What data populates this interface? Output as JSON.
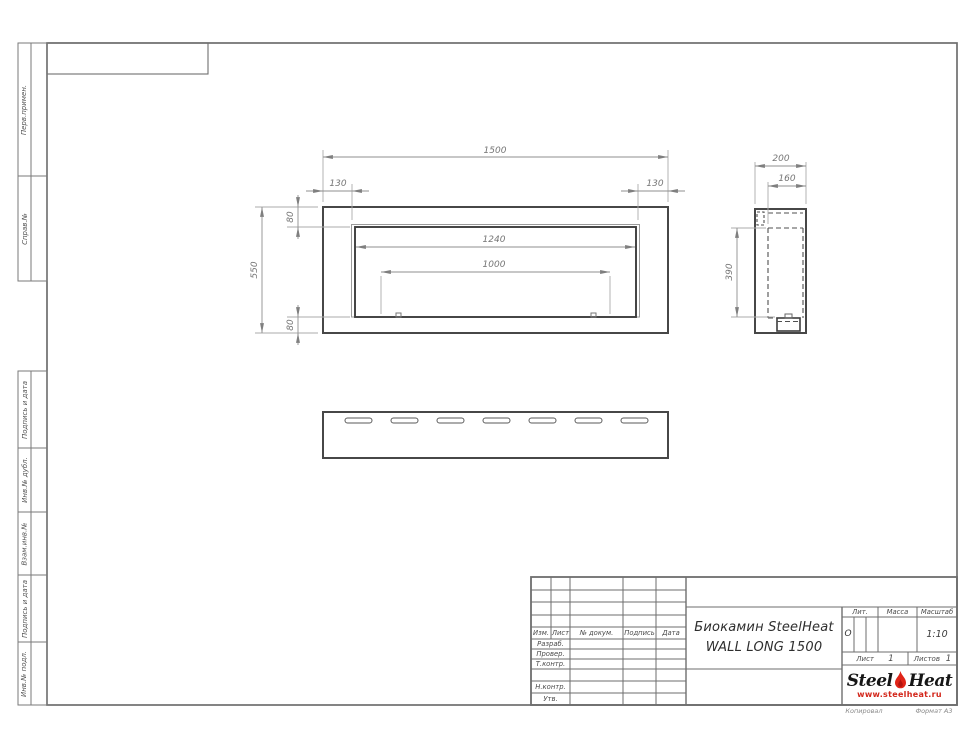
{
  "drawing": {
    "title_line1": "Биокамин SteelHeat",
    "title_line2": "WALL LONG 1500",
    "front_dims": {
      "overall_width": "1500",
      "side_offset_left": "130",
      "side_offset_right": "130",
      "top_offset": "80",
      "bottom_offset": "80",
      "overall_height": "550",
      "opening_width": "1240",
      "burner_width": "1000"
    },
    "side_dims": {
      "depth": "200",
      "inner_depth": "160",
      "opening_height": "390"
    }
  },
  "left_strip": {
    "items": [
      {
        "label": "Перв.примен."
      },
      {
        "label": "Справ.№"
      },
      {
        "label": "Подпись и дата"
      },
      {
        "label": "Инв.№ дубл."
      },
      {
        "label": "Взам.инв.№"
      },
      {
        "label": "Подпись и дата"
      },
      {
        "label": "Инв.№ подл."
      }
    ]
  },
  "title_block": {
    "header_cols": [
      "Изм.",
      "Лист",
      "№ докум.",
      "Подпись",
      "Дата"
    ],
    "row_labels": [
      "Разраб.",
      "Провер.",
      "Т.контр.",
      "Н.контр.",
      "Утв."
    ],
    "lit_label": "Лит.",
    "lit_value": "О",
    "mass_label": "Масса",
    "scale_label": "Масштаб",
    "scale_value": "1:10",
    "sheet_label": "Лист",
    "sheet_value": "1",
    "sheets_label": "Листов",
    "sheets_value": "1",
    "logo": {
      "steel": "Steel",
      "heat": "Heat",
      "url": "www.steelheat.ru"
    }
  },
  "footer": {
    "copied": "Копировал",
    "format": "Формат А3"
  },
  "colors": {
    "accent_red": "#d6261b",
    "line_dark": "#474747",
    "line_mid": "#8f8f8f"
  }
}
